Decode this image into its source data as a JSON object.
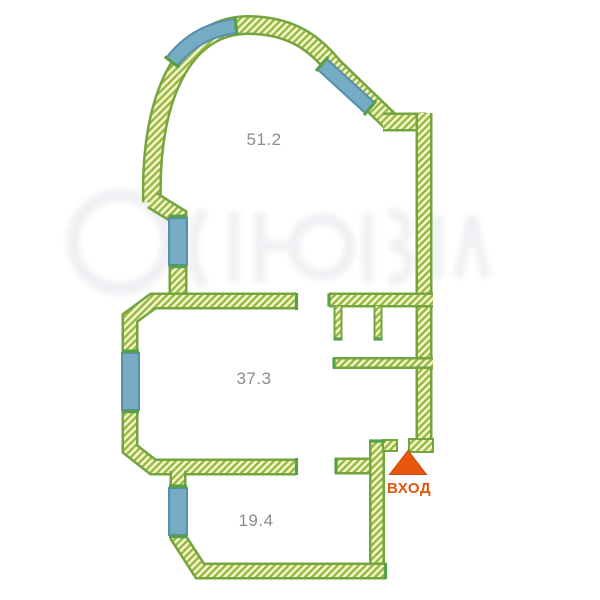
{
  "floorplan": {
    "rooms": [
      {
        "id": "room-top",
        "area_label": "51.2"
      },
      {
        "id": "room-middle",
        "area_label": "37.3"
      },
      {
        "id": "room-bottom",
        "area_label": "19.4"
      }
    ],
    "entrance": {
      "label": "ВХОД",
      "marker": "triangle-up"
    },
    "window_count": 5,
    "colors": {
      "wall_fill": "#f2f7c9",
      "wall_hatch": "#9cb746",
      "wall_border": "#74a53e",
      "window_fill": "#76abc4",
      "window_border": "#568fae",
      "window_cap_green": "#56a049",
      "room_label": "#878d93",
      "entrance_orange": "#e8570e",
      "watermark_gray": "#edeff2",
      "background": "#ffffff"
    }
  }
}
